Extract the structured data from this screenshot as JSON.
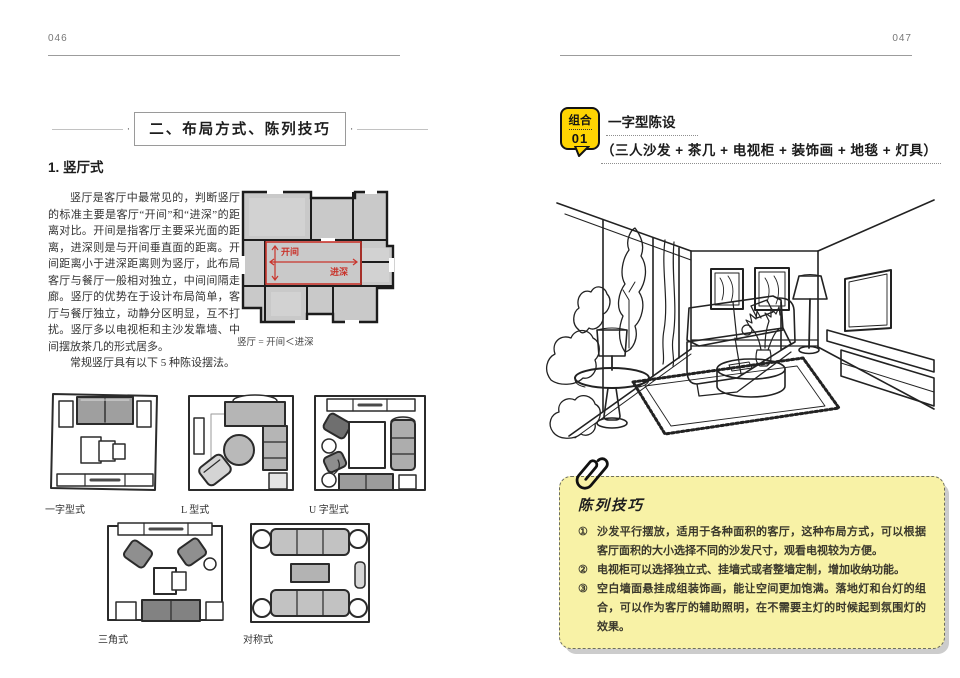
{
  "colors": {
    "accent_red": "#c9342c",
    "badge_yellow": "#ffd502",
    "tips_bg": "#f8f2a6",
    "plan_gray": "#c9c9c9"
  },
  "left_page": {
    "page_number": "046",
    "section_title": "二、布局方式、陈列技巧",
    "subsection_title": "1. 竖厅式",
    "paragraph": "竖厅是客厅中最常见的，判断竖厅的标准主要是客厅“开间”和“进深”的距离对比。开间是指客厅主要采光面的距离，进深则是与开间垂直面的距离。开间距离小于进深距离则为竖厅，此布局客厅与餐厅一般相对独立，中间间隔走廊。竖厅的优势在于设计布局简单，客厅与餐厅独立，动静分区明显，互不打扰。竖厅多以电视柜和主沙发靠墙、中间摆放茶几的形式居多。",
    "paragraph2": "常规竖厅具有以下 5 种陈设摆法。",
    "floorplan": {
      "label_kaijian": "开间",
      "label_jinshen": "进深",
      "caption": "竖厅 = 开间＜进深"
    },
    "diagrams": [
      {
        "label": "一字型式"
      },
      {
        "label": "L 型式"
      },
      {
        "label": "U 字型式"
      },
      {
        "label": "三角式"
      },
      {
        "label": "对称式"
      }
    ]
  },
  "right_page": {
    "page_number": "047",
    "combo_badge": {
      "line1": "组合",
      "line2": "01"
    },
    "combo_title": "一字型陈设",
    "combo_subtitle": "（三人沙发 + 茶几 + 电视柜 + 装饰画 + 地毯 + 灯具）",
    "tips_box": {
      "title": "陈列技巧",
      "items": [
        {
          "marker": "①",
          "text": "沙发平行摆放，适用于各种面积的客厅，这种布局方式，可以根据客厅面积的大小选择不同的沙发尺寸，观看电视较为方便。"
        },
        {
          "marker": "②",
          "text": "电视柜可以选择独立式、挂墙式或者整墙定制，增加收纳功能。"
        },
        {
          "marker": "③",
          "text": "空白墙面悬挂成组装饰画，能让空间更加饱满。落地灯和台灯的组合，可以作为客厅的辅助照明，在不需要主灯的时候起到氛围灯的效果。"
        }
      ]
    }
  }
}
